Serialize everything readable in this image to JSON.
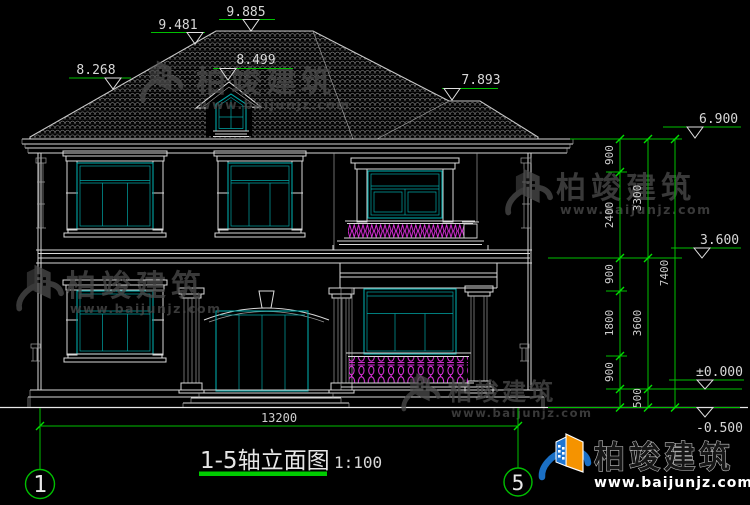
{
  "title": {
    "text": "1-5轴立面图",
    "scale": "1:100"
  },
  "axes": {
    "left": "1",
    "right": "5"
  },
  "levels": {
    "ridge": "9.885",
    "left_slope": "9.481",
    "left_break": "8.268",
    "dormer": "8.499",
    "right_break": "7.893",
    "eave": "6.900",
    "second_floor": "3.600",
    "ground": "±0.000",
    "site": "-0.500"
  },
  "dimensions": {
    "overall_width": "13200",
    "col1": [
      "900",
      "2400",
      "900",
      "1800",
      "900"
    ],
    "col2": [
      "3300",
      "3600",
      "500"
    ],
    "col3": [
      "7400"
    ]
  },
  "watermark": {
    "brand": "柏竣建筑",
    "url": "www.baijunjz.com"
  },
  "footer": {
    "brand": "柏竣建筑",
    "url": "www.baijunjz.com"
  },
  "colors": {
    "background": "#000000",
    "drawing_line": "#d9d9d9",
    "glazing": "#00a6a6",
    "dimension_green": "#00bf00",
    "baluster_magenta": "#e832e8",
    "watermark_gray": "#4a4a4a",
    "logo_blue": "#1a6fc4",
    "logo_orange": "#f59300"
  }
}
